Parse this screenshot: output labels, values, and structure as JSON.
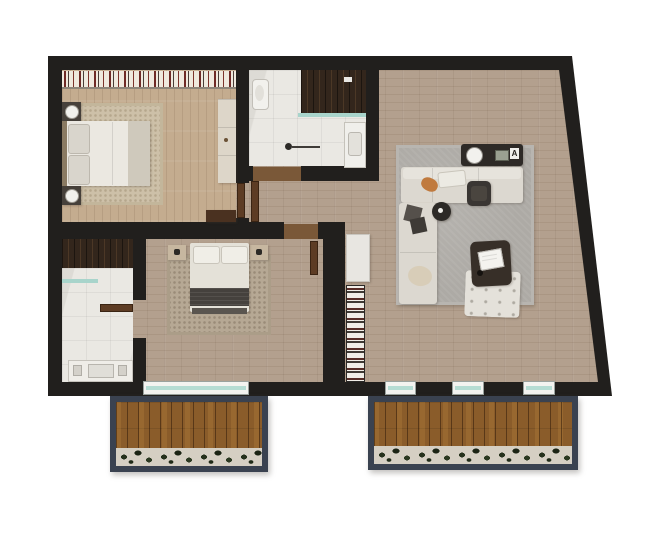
{
  "title": "apartment-floor-plan-render",
  "palette": {
    "background": "#ffffff",
    "walls": "#211f1d",
    "wood_floor_main": "#b3a08e",
    "wood_floor_bedroom": "#c4ac8f",
    "marble_floor": "#eae8e3",
    "balcony_deck": "#8a5c2a",
    "balcony_frame": "#3a4250",
    "window_glass": "#b5dcd3",
    "rug_living": "#adaaa5",
    "rug_bedroom_primary": "#cdc0a8",
    "rug_bedroom_second": "#b6a894",
    "sofa": "#dcd8d0",
    "dark_furniture": "#2e2a27",
    "door_leaf": "#5d3c24",
    "accent_pillow": "#c07a3e",
    "plants": "#25311c",
    "closet_stripe_red": "#6f2a26"
  },
  "living_room": {
    "console_tag": "A",
    "furniture": [
      "corner-sofa",
      "tv-console",
      "office-chair",
      "round-side-table",
      "square-coffee-table",
      "tufted-ottoman",
      "gray-area-rug",
      "white-cabinet",
      "striped-shelf"
    ]
  },
  "rooms": [
    {
      "id": "bedroom-primary",
      "floor": "light-wood-vertical-planks",
      "features": [
        "striped-closet-strip",
        "double-bed",
        "nightstand-lamps",
        "beige-rug",
        "dresser",
        "low-cabinet"
      ]
    },
    {
      "id": "bathroom-top",
      "floor": "white-marble",
      "features": [
        "dark-wood-shower",
        "glass-screen",
        "toilet",
        "sink-counter",
        "towel-stand"
      ]
    },
    {
      "id": "hallway",
      "floor": "wood",
      "features": []
    },
    {
      "id": "bedroom-second",
      "floor": "wood-horizontal-planks",
      "features": [
        "double-bed",
        "two-nightstands",
        "tan-rug",
        "balcony-window"
      ]
    },
    {
      "id": "bathroom-left",
      "floor": "white-marble",
      "features": [
        "dark-wood-closet-strip",
        "glass-screen",
        "vanity-sink"
      ]
    },
    {
      "id": "living-room",
      "floor": "wood-horizontal-planks",
      "features": [
        "angled-exterior-wall"
      ]
    }
  ],
  "balconies": [
    {
      "id": "balcony-left",
      "deck": "wood-planks",
      "planter": "green-shrub-row"
    },
    {
      "id": "balcony-right",
      "deck": "wood-planks",
      "planter": "green-shrub-row"
    }
  ],
  "openings": {
    "door_count": 4,
    "window_count": 4,
    "windows": [
      "bedroom-second-sliding-window",
      "living-window-1",
      "living-window-2",
      "living-window-3"
    ]
  }
}
